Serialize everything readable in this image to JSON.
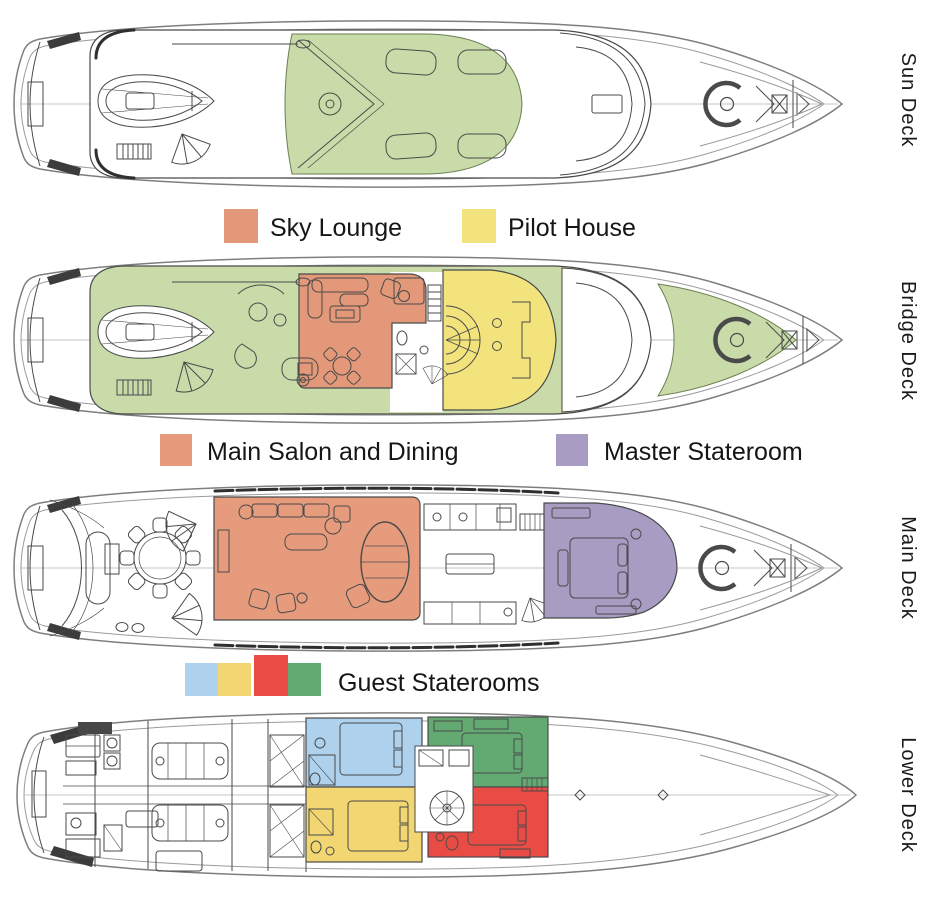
{
  "colors": {
    "deck_green": "#c8dba9",
    "sky_lounge": "#e29879",
    "pilot_house": "#f2e37c",
    "main_salon": "#e59b7c",
    "master_stateroom": "#a89cc3",
    "guest_blue": "#aed2ee",
    "guest_yellow": "#f2d671",
    "guest_red": "#e84c44",
    "guest_green": "#62aa72"
  },
  "decks": [
    {
      "label": "Sun Deck"
    },
    {
      "label": "Bridge Deck"
    },
    {
      "label": "Main Deck"
    },
    {
      "label": "Lower Deck"
    }
  ],
  "legends": {
    "sky_lounge": "Sky Lounge",
    "pilot_house": "Pilot House",
    "main_salon": "Main Salon and Dining",
    "master_stateroom": "Master Stateroom",
    "guest_staterooms": "Guest Staterooms"
  }
}
